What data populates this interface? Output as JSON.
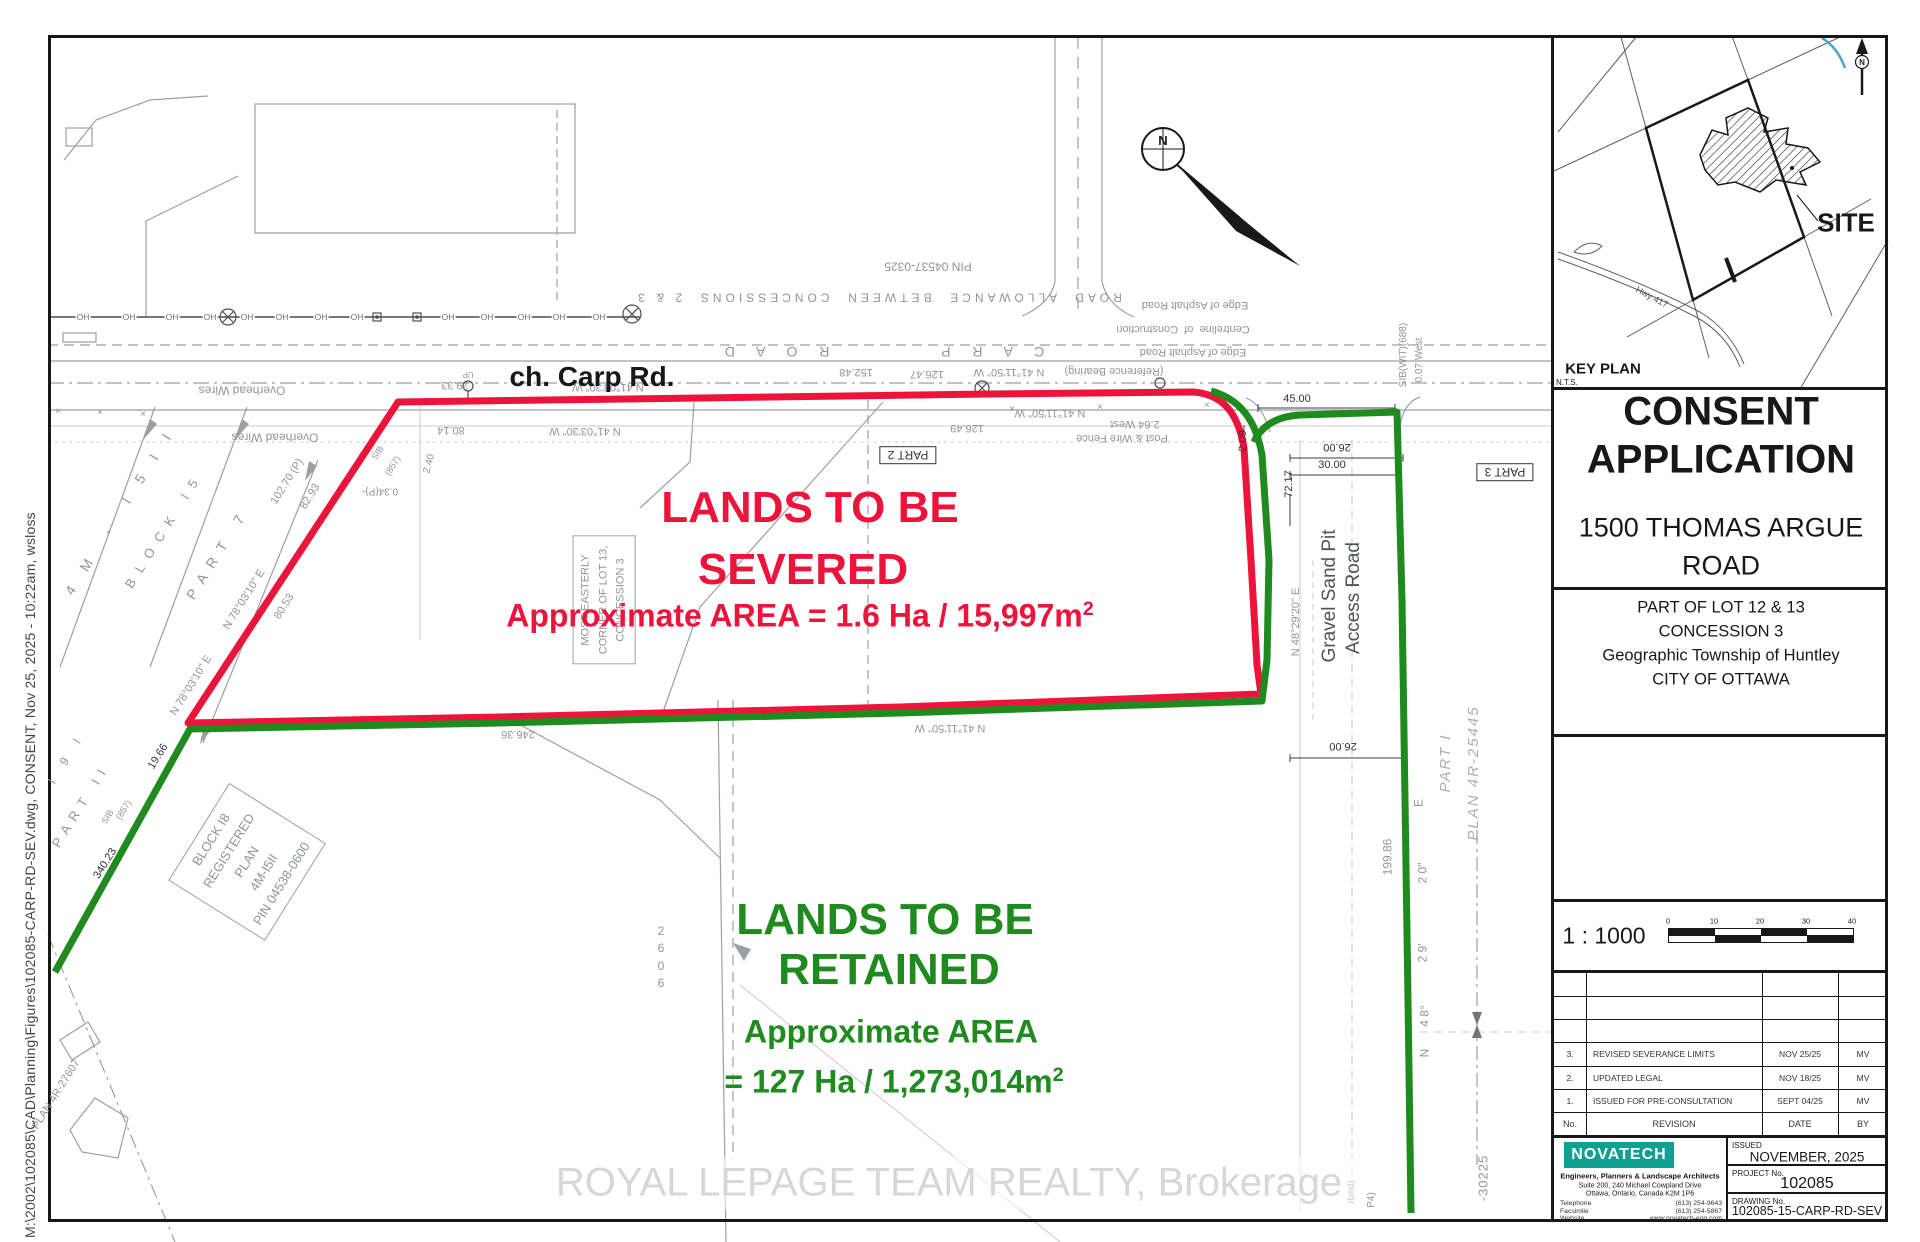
{
  "colors": {
    "severed_red": "#ed143c",
    "retained_green": "#1f8b1f",
    "novatech_teal": "#0fa093",
    "keyplan_blue": "#4aa6cc",
    "watermark_gray": "#d7d7d7"
  },
  "sheet": {
    "plot_stamp": "M:\\2002\\102085\\CAD\\Planning\\Figures\\102085-CARP-RD-SEV.dwg, CONSENT, Nov 25, 2025 - 10:22am, wsloss",
    "watermark": "ROYAL LEPAGE TEAM REALTY, Brokerage"
  },
  "drawing": {
    "road_label": "ch. Carp Rd.",
    "north_label": "N",
    "oh_label": "OH",
    "severed": {
      "line1": "LANDS TO BE",
      "line2": "SEVERED",
      "area": "Approximate AREA = 1.6 Ha / 15,997m",
      "area_exp": "2"
    },
    "retained": {
      "line1": "LANDS TO BE",
      "line2": "RETAINED",
      "area1": "Approximate AREA",
      "area2": "= 127 Ha / 1,273,014m",
      "area_exp": "2"
    },
    "annotations": [
      {
        "t": "PIN 04537-0325",
        "x": 928,
        "y": 266,
        "r": 180,
        "s": 12
      },
      {
        "t": "ROAD  ALLOWANCE  BETWEEN  CONCESSIONS  2 & 3",
        "x": 878,
        "y": 297,
        "r": 180,
        "s": 12,
        "ls": 4
      },
      {
        "t": "C A R P        R O A D",
        "x": 880,
        "y": 352,
        "r": 180,
        "s": 14,
        "ls": 9
      },
      {
        "t": "Edge of Asphalt Road",
        "x": 1195,
        "y": 304,
        "r": 180,
        "s": 11
      },
      {
        "t": "Centreline  of  Construction",
        "x": 1183,
        "y": 328,
        "r": 180,
        "s": 11
      },
      {
        "t": "Edge of Asphalt Road",
        "x": 1193,
        "y": 351,
        "r": 180,
        "s": 11
      },
      {
        "t": "(Reference Bearing)",
        "x": 1114,
        "y": 370,
        "r": 180,
        "s": 11
      },
      {
        "t": "N 41°11'50\" W",
        "x": 1009,
        "y": 371,
        "r": 180,
        "s": 11
      },
      {
        "t": "126.47",
        "x": 927,
        "y": 373,
        "r": 180,
        "s": 11
      },
      {
        "t": "152.48",
        "x": 856,
        "y": 371,
        "r": 180,
        "s": 11
      },
      {
        "t": "N 41°03'30\" W",
        "x": 608,
        "y": 386,
        "r": 180,
        "s": 11
      },
      {
        "t": "79.33",
        "x": 455,
        "y": 384,
        "r": 180,
        "s": 11
      },
      {
        "t": "UP",
        "x": 468,
        "y": 374,
        "r": 180,
        "s": 8
      },
      {
        "t": "80.14",
        "x": 451,
        "y": 429,
        "r": 180,
        "s": 11
      },
      {
        "t": "N 41°03'30\" W",
        "x": 585,
        "y": 430,
        "r": 180,
        "s": 11
      },
      {
        "t": "126.49",
        "x": 967,
        "y": 427,
        "r": 180,
        "s": 11
      },
      {
        "t": "N 41°11'50\" W",
        "x": 1050,
        "y": 412,
        "r": 180,
        "s": 11
      },
      {
        "t": "2.64 West",
        "x": 1135,
        "y": 423,
        "r": 180,
        "s": 11
      },
      {
        "t": "Post & Wire Fence",
        "x": 1122,
        "y": 437,
        "r": 180,
        "s": 11
      },
      {
        "t": "Overhead Wires",
        "x": 242,
        "y": 390,
        "r": 180,
        "s": 12
      },
      {
        "t": "Overhead Wires",
        "x": 275,
        "y": 437,
        "r": 180,
        "s": 12
      },
      {
        "t": "246.36",
        "x": 518,
        "y": 733,
        "r": 180,
        "s": 11
      },
      {
        "t": "N 41°11'50\" W",
        "x": 950,
        "y": 727,
        "r": 180,
        "s": 11
      },
      {
        "t": "×",
        "x": 58,
        "y": 412,
        "s": 10
      },
      {
        "t": "×",
        "x": 100,
        "y": 413,
        "s": 10
      },
      {
        "t": "×",
        "x": 143,
        "y": 415,
        "s": 10
      },
      {
        "t": "×",
        "x": 1012,
        "y": 410,
        "s": 10
      },
      {
        "t": "×",
        "x": 1100,
        "y": 408,
        "s": 10
      },
      {
        "t": "×",
        "x": 1207,
        "y": 406,
        "s": 10
      },
      {
        "t": "4 M  -  I 5 I I",
        "x": 120,
        "y": 511,
        "r": -58,
        "s": 14,
        "ls": 8
      },
      {
        "t": "B L O C K   I 5",
        "x": 163,
        "y": 533,
        "r": -58,
        "s": 13,
        "ls": 3
      },
      {
        "t": "P A R T   7",
        "x": 216,
        "y": 556,
        "r": -58,
        "s": 14,
        "ls": 3
      },
      {
        "t": "N 78°03'10\" E",
        "x": 245,
        "y": 600,
        "r": -58,
        "s": 11
      },
      {
        "t": "N 78°03'10\" E",
        "x": 192,
        "y": 686,
        "r": -58,
        "s": 11
      },
      {
        "t": "102.70 (P)",
        "x": 288,
        "y": 482,
        "r": -58,
        "s": 11
      },
      {
        "t": "82.93",
        "x": 311,
        "y": 497,
        "r": -58,
        "s": 11
      },
      {
        "t": "80.53",
        "x": 285,
        "y": 607,
        "r": -58,
        "s": 11
      },
      {
        "t": "19.66",
        "x": 159,
        "y": 757,
        "r": -58,
        "s": 11,
        "c": "k"
      },
      {
        "t": "340.23",
        "x": 106,
        "y": 864,
        "r": -58,
        "s": 11,
        "c": "k"
      },
      {
        "t": "SIB",
        "x": 108,
        "y": 817,
        "r": -58,
        "s": 9
      },
      {
        "t": "(857)",
        "x": 124,
        "y": 810,
        "r": -58,
        "s": 9
      },
      {
        "t": "SIB",
        "x": 378,
        "y": 453,
        "r": -58,
        "s": 9
      },
      {
        "t": "(857)",
        "x": 393,
        "y": 466,
        "r": -58,
        "s": 9
      },
      {
        "t": "0.34(P)-",
        "x": 380,
        "y": 490,
        "r": 180,
        "s": 10
      },
      {
        "t": "2.40",
        "x": 430,
        "y": 464,
        "r": -75,
        "s": 10
      },
      {
        "t": "P A R T   I I",
        "x": 80,
        "y": 808,
        "r": -58,
        "s": 13,
        "ls": 2
      },
      {
        "t": "I  9  I",
        "x": 66,
        "y": 760,
        "r": -58,
        "s": 12,
        "ls": 4
      },
      {
        "t": "PLAN 4R-27607",
        "x": 57,
        "y": 1095,
        "r": -58,
        "s": 11
      },
      {
        "t": "BLOCK I8\nREGISTERED\nPLAN\n4M-I5II\nPIN 04538-0600",
        "x": 247,
        "y": 862,
        "r": -58,
        "s": 13,
        "c": "gbox"
      },
      {
        "t": "MOST EASTERLY\nCORNER OF LOT 13,\nCONCESSION 3",
        "x": 604,
        "y": 600,
        "r": -90,
        "s": 11,
        "c": "gbox"
      },
      {
        "t": "2\n6\n0\n6",
        "x": 661,
        "y": 958,
        "s": 12
      },
      {
        "t": "45.00",
        "x": 1297,
        "y": 400,
        "s": 11,
        "c": "k"
      },
      {
        "t": "26.00",
        "x": 1337,
        "y": 446,
        "r": 180,
        "s": 11,
        "c": "k"
      },
      {
        "t": "30.00",
        "x": 1332,
        "y": 466,
        "s": 11,
        "c": "k"
      },
      {
        "t": "72.17",
        "x": 1290,
        "y": 484,
        "r": -90,
        "s": 11,
        "c": "k"
      },
      {
        "t": "2.09",
        "x": 1244,
        "y": 441,
        "r": -90,
        "s": 11,
        "c": "k"
      },
      {
        "t": "N 48°29'20\" E",
        "x": 1297,
        "y": 622,
        "r": -90,
        "s": 11
      },
      {
        "t": "Gravel Sand Pit",
        "x": 1330,
        "y": 596,
        "r": -90,
        "s": 19,
        "c": "d"
      },
      {
        "t": "Access Road",
        "x": 1354,
        "y": 598,
        "r": -90,
        "s": 19,
        "c": "d"
      },
      {
        "t": "PART I",
        "x": 1446,
        "y": 763,
        "r": -90,
        "s": 15,
        "c": "gi",
        "ls": 2
      },
      {
        "t": "PLAN 4R-25445",
        "x": 1474,
        "y": 773,
        "r": -90,
        "s": 15,
        "c": "gi",
        "ls": 2
      },
      {
        "t": "199.86",
        "x": 1388,
        "y": 857,
        "r": -90,
        "s": 12
      },
      {
        "t": "E",
        "x": 1419,
        "y": 803,
        "r": -90,
        "s": 12
      },
      {
        "t": "2 0\"",
        "x": 1423,
        "y": 873,
        "r": -90,
        "s": 12
      },
      {
        "t": "2 9'",
        "x": 1423,
        "y": 953,
        "r": -90,
        "s": 12
      },
      {
        "t": "4 8°",
        "x": 1425,
        "y": 1016,
        "r": -90,
        "s": 12
      },
      {
        "t": "N",
        "x": 1425,
        "y": 1053,
        "r": -90,
        "s": 12
      },
      {
        "t": "SIB(WIT)(688)",
        "x": 1404,
        "y": 355,
        "r": -90,
        "s": 10
      },
      {
        "t": "0.07 West",
        "x": 1420,
        "y": 360,
        "r": -90,
        "s": 10
      },
      {
        "t": "-30225",
        "x": 1484,
        "y": 1178,
        "r": -90,
        "s": 13,
        "ls": 1
      },
      {
        "t": "26.00",
        "x": 1343,
        "y": 745,
        "r": 180,
        "s": 11,
        "c": "k"
      },
      {
        "t": "rbed)",
        "x": 1352,
        "y": 1192,
        "r": -90,
        "s": 10
      },
      {
        "t": "P4)",
        "x": 1372,
        "y": 1200,
        "r": -90,
        "s": 10
      },
      {
        "t": "PART 2",
        "x": 908,
        "y": 455,
        "r": 180,
        "s": 12,
        "c": "kbox"
      },
      {
        "t": "PART 3",
        "x": 1505,
        "y": 472,
        "r": 180,
        "s": 12,
        "c": "kbox"
      }
    ]
  },
  "title_block": {
    "key_plan": {
      "heading": "KEY PLAN",
      "scale_note": "N.T.S.",
      "site_label": "SITE",
      "highway_label": "Hwy 417",
      "north_label": "N"
    },
    "project_title_line1": "CONSENT",
    "project_title_line2": "APPLICATION",
    "address_line1": "1500 THOMAS ARGUE",
    "address_line2": "ROAD",
    "legal_lines": [
      "PART OF LOT 12 & 13",
      "CONCESSION 3",
      "Geographic Township of Huntley",
      "CITY OF OTTAWA"
    ],
    "scale": {
      "ratio": "1 : 1000",
      "ticks": [
        "0",
        "10",
        "20",
        "30",
        "40"
      ]
    },
    "revisions": {
      "columns": {
        "no": "No.",
        "revision": "REVISION",
        "date": "DATE",
        "by": "BY"
      },
      "rows": [
        {
          "no": "3.",
          "revision": "REVISED SEVERANCE LIMITS",
          "date": "NOV 25/25",
          "by": "MV"
        },
        {
          "no": "2.",
          "revision": "UPDATED LEGAL",
          "date": "NOV 18/25",
          "by": "MV"
        },
        {
          "no": "1.",
          "revision": "ISSUED FOR PRE-CONSULTATION",
          "date": "SEPT 04/25",
          "by": "MV"
        }
      ]
    },
    "firm": {
      "name": "NOVATECH",
      "tagline": "Engineers, Planners & Landscape Architects",
      "address_line1": "Suite 200, 240 Michael Cowpland Drive",
      "address_line2": "Ottawa, Ontario, Canada K2M 1P6",
      "contacts": [
        {
          "label": "Telephone",
          "value": "(613) 254-9643"
        },
        {
          "label": "Facsimile",
          "value": "(613) 254-5867"
        },
        {
          "label": "Website",
          "value": "www.novatech-eng.com"
        }
      ]
    },
    "issued": {
      "label": "ISSUED",
      "value": "NOVEMBER, 2025"
    },
    "project": {
      "label": "PROJECT No.",
      "value": "102085"
    },
    "drawing_number": {
      "label": "DRAWING No.",
      "value": "102085-15-CARP-RD-SEV"
    }
  }
}
